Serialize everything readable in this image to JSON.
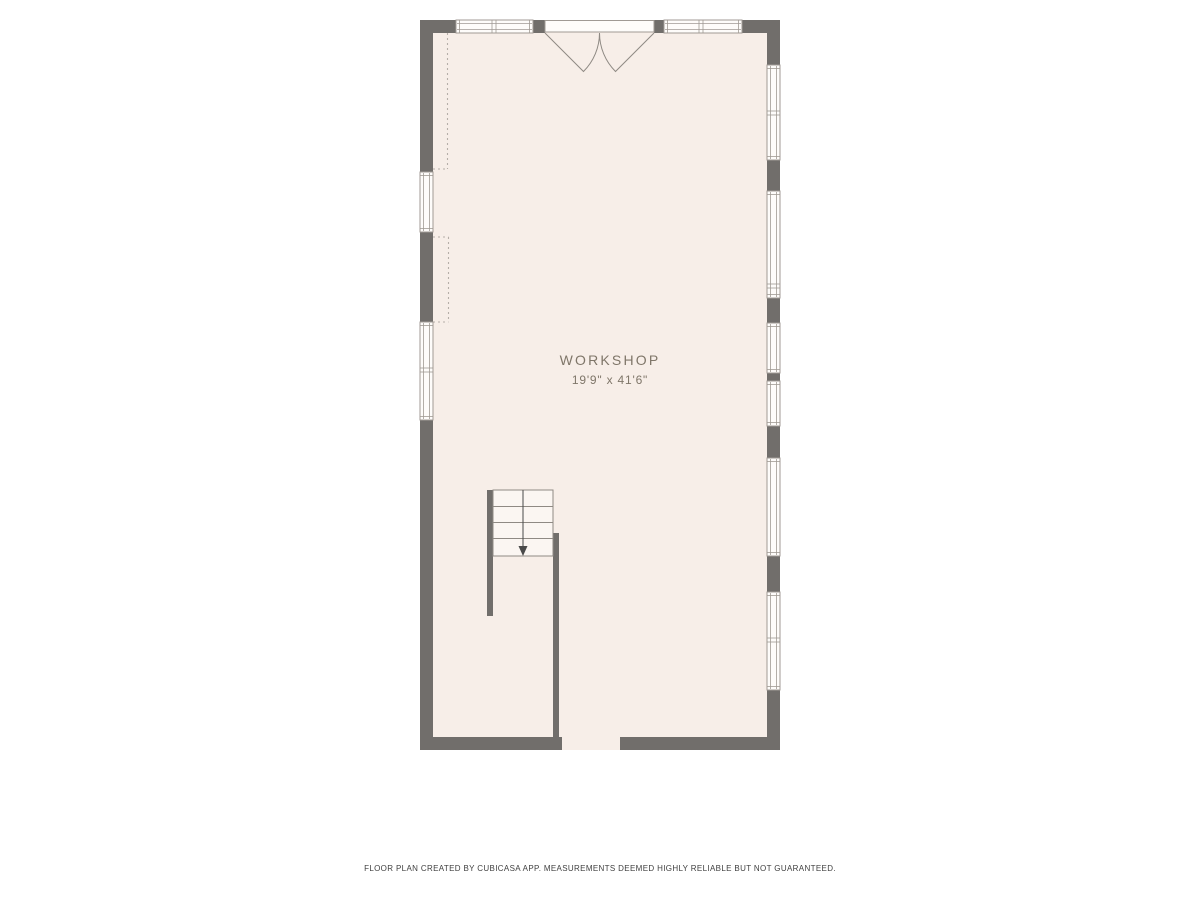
{
  "page": {
    "background": "#ffffff"
  },
  "plan": {
    "room": {
      "label": "WORKSHOP",
      "dimensions": "19'9\" x 41'6\""
    },
    "footer": "FLOOR PLAN CREATED BY CUBICASA APP. MEASUREMENTS DEEMED HIGHLY RELIABLE BUT NOT GUARANTEED.",
    "colors": {
      "floor": "#f7eee8",
      "wall": "#716e6b",
      "window_fill": "#fefcfa",
      "window_stroke": "#a09a94",
      "door_stroke": "#8f8a84",
      "stair_fill": "#fbf6f2",
      "stair_stroke": "#8f8a84",
      "dash_stroke": "#b5afa8",
      "arrow": "#4a4a4a",
      "label_text": "#7f7669",
      "footer_text": "#3f3f3f"
    },
    "geometry": {
      "outer": {
        "x": 420,
        "y": 20,
        "w": 360,
        "h": 730
      },
      "walls": [
        {
          "x": 420,
          "y": 20,
          "w": 36,
          "h": 13
        },
        {
          "x": 533,
          "y": 20,
          "w": 12,
          "h": 13
        },
        {
          "x": 654,
          "y": 20,
          "w": 10,
          "h": 13
        },
        {
          "x": 742,
          "y": 20,
          "w": 38,
          "h": 13
        },
        {
          "x": 420,
          "y": 20,
          "w": 13,
          "h": 152
        },
        {
          "x": 420,
          "y": 232,
          "w": 13,
          "h": 90
        },
        {
          "x": 420,
          "y": 420,
          "w": 13,
          "h": 330
        },
        {
          "x": 767,
          "y": 20,
          "w": 13,
          "h": 45
        },
        {
          "x": 767,
          "y": 160,
          "w": 13,
          "h": 31
        },
        {
          "x": 767,
          "y": 298,
          "w": 13,
          "h": 25
        },
        {
          "x": 767,
          "y": 373,
          "w": 13,
          "h": 8
        },
        {
          "x": 767,
          "y": 426,
          "w": 13,
          "h": 32
        },
        {
          "x": 767,
          "y": 556,
          "w": 13,
          "h": 36
        },
        {
          "x": 767,
          "y": 690,
          "w": 13,
          "h": 60
        },
        {
          "x": 420,
          "y": 737,
          "w": 142,
          "h": 13
        },
        {
          "x": 620,
          "y": 737,
          "w": 160,
          "h": 13
        },
        {
          "x": 487,
          "y": 490,
          "w": 6,
          "h": 126
        },
        {
          "x": 553,
          "y": 533,
          "w": 6,
          "h": 204
        }
      ],
      "windows": [
        {
          "x": 456,
          "y": 20,
          "w": 77,
          "h": 13,
          "orient": "h",
          "mullions": [
            494
          ]
        },
        {
          "x": 664,
          "y": 20,
          "w": 78,
          "h": 13,
          "orient": "h",
          "mullions": [
            701
          ]
        },
        {
          "x": 420,
          "y": 172,
          "w": 13,
          "h": 60,
          "orient": "v",
          "mullions": []
        },
        {
          "x": 420,
          "y": 322,
          "w": 13,
          "h": 98,
          "orient": "v",
          "mullions": [
            370
          ]
        },
        {
          "x": 767,
          "y": 65,
          "w": 13,
          "h": 95,
          "orient": "v",
          "mullions": [
            113
          ]
        },
        {
          "x": 767,
          "y": 191,
          "w": 13,
          "h": 107,
          "orient": "v",
          "mullions": [
            286
          ]
        },
        {
          "x": 767,
          "y": 323,
          "w": 13,
          "h": 50,
          "orient": "v",
          "mullions": []
        },
        {
          "x": 767,
          "y": 381,
          "w": 13,
          "h": 45,
          "orient": "v",
          "mullions": []
        },
        {
          "x": 767,
          "y": 458,
          "w": 13,
          "h": 98,
          "orient": "v",
          "mullions": []
        },
        {
          "x": 767,
          "y": 592,
          "w": 13,
          "h": 98,
          "orient": "v",
          "mullions": [
            640
          ]
        }
      ],
      "door": {
        "opening": {
          "x": 545,
          "y": 20,
          "w": 109,
          "h": 13
        },
        "leaf_left": "M 545,33 L 583.5,71.5 A 54.5,54.5 0 0 0 599.5,33",
        "leaf_right": "M 654,33 L 615.5,71.5 A 54.5,54.5 0 0 1 599.5,33"
      },
      "stairs": {
        "rect": {
          "x": 493,
          "y": 490,
          "w": 60,
          "h": 66
        },
        "treads_y": [
          506.5,
          522.5,
          538.5
        ],
        "center_x": 523,
        "line_y1": 490,
        "line_y2": 547,
        "arrow": "518.5,546 527.5,546 523,556"
      },
      "dashed_lines": [
        {
          "x1": 447.5,
          "y1": 33,
          "x2": 447.5,
          "y2": 169
        },
        {
          "x1": 433,
          "y1": 169,
          "x2": 447.5,
          "y2": 169
        },
        {
          "x1": 433,
          "y1": 237,
          "x2": 448.5,
          "y2": 237
        },
        {
          "x1": 448.5,
          "y1": 237,
          "x2": 448.5,
          "y2": 322
        },
        {
          "x1": 433,
          "y1": 322,
          "x2": 448.5,
          "y2": 322
        }
      ]
    }
  }
}
